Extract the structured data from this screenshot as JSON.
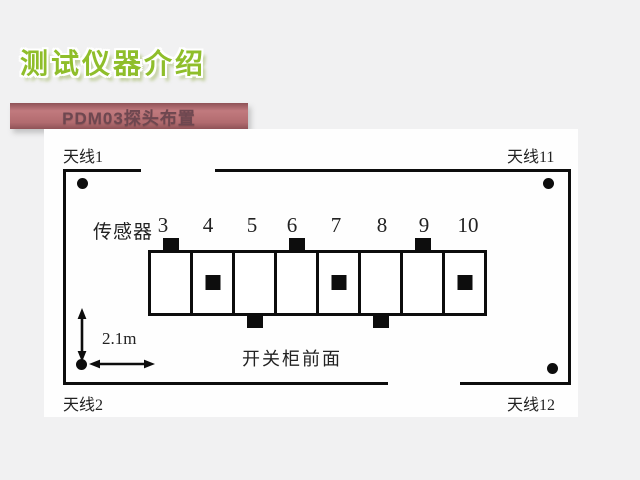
{
  "slide": {
    "title": "测试仪器介绍",
    "subtitle": "PDM03探头布置"
  },
  "diagram": {
    "antennas": {
      "top_left": "天线1",
      "top_right": "天线11",
      "bottom_left": "天线2",
      "bottom_right": "天线12"
    },
    "sensor_group_label": "传感器",
    "sensors": [
      {
        "number": "3",
        "marker": "top"
      },
      {
        "number": "4",
        "marker": "inner"
      },
      {
        "number": "5",
        "marker": "bottom"
      },
      {
        "number": "6",
        "marker": "top"
      },
      {
        "number": "7",
        "marker": "inner"
      },
      {
        "number": "8",
        "marker": "bottom"
      },
      {
        "number": "9",
        "marker": "top"
      },
      {
        "number": "10",
        "marker": "inner"
      }
    ],
    "dimension_label": "2.1m",
    "cabinet_front_label": "开关柜前面"
  },
  "colors": {
    "title_green": "#8fbe2a",
    "bar_background": "#b26b6f",
    "bar_background_dark": "#8f5257",
    "bar_text": "#6e4750",
    "line_black": "#0d0d0d",
    "page_background": "#f1f1f2",
    "panel_white": "#fefefe"
  }
}
